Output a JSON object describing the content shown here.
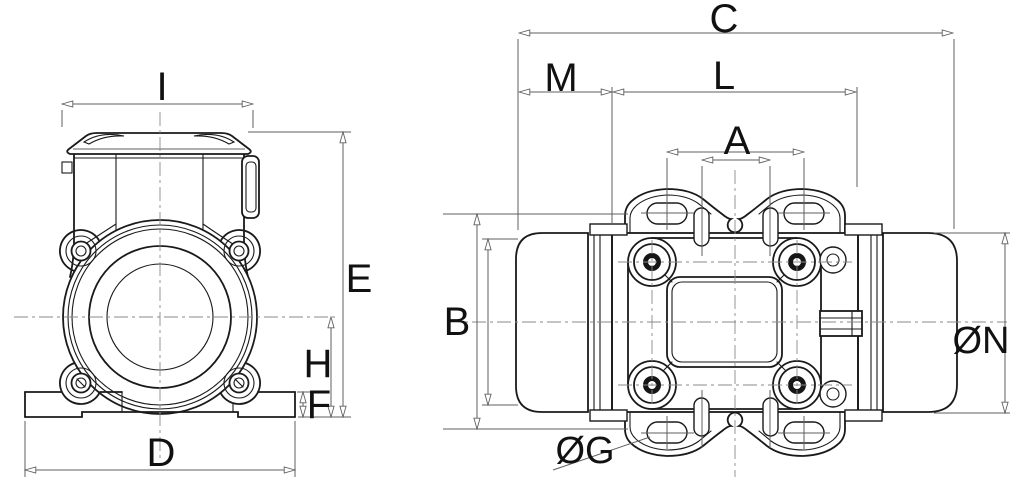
{
  "colors": {
    "background": "#ffffff",
    "object_line": "#1a1a1a",
    "dimension_line": "#5f5f5f",
    "centerline": "#8a8a8a",
    "label_text": "#111111"
  },
  "front_view": {
    "description": "front end view of vibration motor",
    "dim_labels": {
      "I": "I",
      "E": "E",
      "H": "H",
      "F": "F",
      "D": "D"
    }
  },
  "top_view": {
    "description": "top plan view of vibration motor",
    "dim_labels": {
      "C": "C",
      "M": "M",
      "L": "L",
      "A": "A",
      "B": "B",
      "N": "ØN",
      "G": "ØG"
    }
  }
}
